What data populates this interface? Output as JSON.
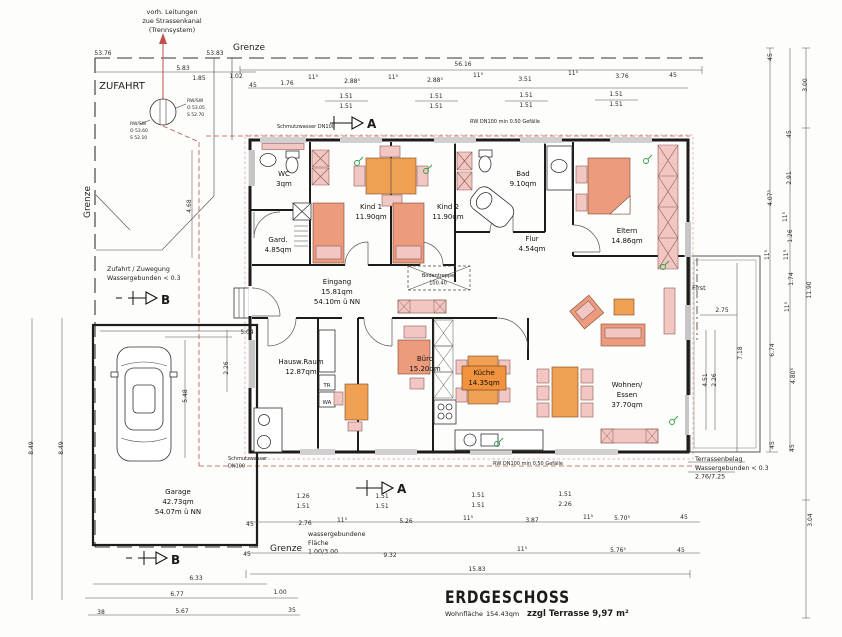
{
  "title_block": {
    "title": "ERDGESCHOSS",
    "area_label": "Wohnfläche",
    "area_value": "154.43qm",
    "terrace_note": "zzgl Terrasse 9,97 m²"
  },
  "markers": {
    "section_a": "A",
    "section_b": "B"
  },
  "colors": {
    "furniture_salmon": "#ec9b7d",
    "furniture_pink": "#f2c6c2",
    "accent_orange": "#f0a052",
    "pipe_red": "#c0504a",
    "symbol_green": "#2f9e44",
    "wall_black": "#1c1c1c"
  },
  "rooms": [
    {
      "lines": [
        "WC",
        "3qm"
      ],
      "x": 284,
      "y": 176
    },
    {
      "lines": [
        "Gard.",
        "4.85qm"
      ],
      "x": 278,
      "y": 242
    },
    {
      "lines": [
        "Kind 1",
        "11.90qm"
      ],
      "x": 371,
      "y": 209
    },
    {
      "lines": [
        "Kind 2",
        "11.90qm"
      ],
      "x": 448,
      "y": 209
    },
    {
      "lines": [
        "Bad",
        "9.10qm"
      ],
      "x": 523,
      "y": 176
    },
    {
      "lines": [
        "Eltern",
        "14.86qm"
      ],
      "x": 627,
      "y": 233
    },
    {
      "lines": [
        "Flur",
        "4.54qm"
      ],
      "x": 532,
      "y": 241
    },
    {
      "lines": [
        "Eingang",
        "15.81qm",
        "54.10m ü NN"
      ],
      "x": 337,
      "y": 284
    },
    {
      "lines": [
        "Hausw.Raum",
        "12.87qm"
      ],
      "x": 301,
      "y": 364
    },
    {
      "lines": [
        "Büro",
        "15.20qm"
      ],
      "x": 425,
      "y": 361
    },
    {
      "lines": [
        "Wohnen/",
        "Essen",
        "37.70qm"
      ],
      "x": 627,
      "y": 387
    },
    {
      "lines": [
        "Garage",
        "42.73qm",
        "54.07m ü NN"
      ],
      "x": 178,
      "y": 494
    }
  ],
  "kitchen_label": {
    "lines": [
      "Küche",
      "14.35qm"
    ],
    "x": 484,
    "y": 375
  },
  "annotations": [
    {
      "lines": [
        "vorh. Leitungen",
        "zue Strassenkanal",
        "(Trennsystem)"
      ],
      "x": 172,
      "y": 14,
      "s": 6.5,
      "a": "m"
    },
    {
      "lines": [
        "Grenze"
      ],
      "x": 249,
      "y": 50,
      "s": 9,
      "a": "m"
    },
    {
      "lines": [
        "Grenze"
      ],
      "x": 90,
      "y": 202,
      "s": 9,
      "a": "m",
      "r": -90
    },
    {
      "lines": [
        "Grenze"
      ],
      "x": 286,
      "y": 551,
      "s": 9,
      "a": "m"
    },
    {
      "lines": [
        "ZUFAHRT"
      ],
      "x": 122,
      "y": 89,
      "s": 10,
      "a": "m"
    },
    {
      "lines": [
        "Zufahrt / Zuwegung",
        "Wassergebunden < 0.3"
      ],
      "x": 107,
      "y": 271,
      "s": 6.3,
      "a": "s"
    },
    {
      "lines": [
        "wassergebundene",
        "Fläche",
        "1.00/3.00"
      ],
      "x": 308,
      "y": 536,
      "s": 6.3,
      "a": "s"
    },
    {
      "lines": [
        "Terrassenbelag",
        "Wassergebunden < 0.3",
        "2.76/7.25"
      ],
      "x": 695,
      "y": 461,
      "s": 6.3,
      "a": "s"
    },
    {
      "lines": [
        "First"
      ],
      "x": 692,
      "y": 290,
      "s": 6.5,
      "a": "s"
    },
    {
      "lines": [
        "Schmutzwasser DN100"
      ],
      "x": 277,
      "y": 128,
      "s": 5,
      "a": "s"
    },
    {
      "lines": [
        "RW DN100 min 0.50 Gefälle"
      ],
      "x": 505,
      "y": 123,
      "s": 5,
      "a": "m"
    },
    {
      "lines": [
        "RW DN100 min 0.50 Gefälle"
      ],
      "x": 528,
      "y": 465,
      "s": 5,
      "a": "m"
    },
    {
      "lines": [
        "Schmutzwasser",
        "DN100"
      ],
      "x": 228,
      "y": 460,
      "s": 5,
      "a": "s"
    },
    {
      "lines": [
        "RW/SW",
        "O 53.05",
        "S 52.70"
      ],
      "x": 187,
      "y": 102,
      "s": 4.5,
      "a": "s"
    },
    {
      "lines": [
        "RW/SW",
        "O 53.60",
        "S 52.10"
      ],
      "x": 130,
      "y": 125,
      "s": 4.5,
      "a": "s"
    },
    {
      "lines": [
        "Bodentreppe",
        "100.40"
      ],
      "x": 438,
      "y": 277,
      "s": 5,
      "a": "m"
    },
    {
      "lines": [
        "TR"
      ],
      "x": 327,
      "y": 387,
      "s": 5.5,
      "a": "m"
    },
    {
      "lines": [
        "WA"
      ],
      "x": 327,
      "y": 404,
      "s": 5.5,
      "a": "m"
    }
  ],
  "dims": [
    {
      "t": "56.16",
      "x": 463,
      "y": 66
    },
    {
      "t": "1.85",
      "x": 199,
      "y": 80
    },
    {
      "t": "1.02",
      "x": 236,
      "y": 78
    },
    {
      "t": "45",
      "x": 253,
      "y": 87
    },
    {
      "t": "1.76",
      "x": 287,
      "y": 85
    },
    {
      "t": "11⁵",
      "x": 313,
      "y": 79
    },
    {
      "t": "2.88⁵",
      "x": 352,
      "y": 83
    },
    {
      "t": "11⁵",
      "x": 393,
      "y": 79
    },
    {
      "t": "2.88⁵",
      "x": 435,
      "y": 82
    },
    {
      "t": "11⁵",
      "x": 478,
      "y": 77
    },
    {
      "t": "3.51",
      "x": 525,
      "y": 81
    },
    {
      "t": "11⁵",
      "x": 573,
      "y": 75
    },
    {
      "t": "3.76",
      "x": 622,
      "y": 78
    },
    {
      "t": "45",
      "x": 673,
      "y": 77
    },
    {
      "t": "1.51",
      "x": 346,
      "y": 98
    },
    {
      "t": "1.51",
      "x": 346,
      "y": 108
    },
    {
      "t": "1.51",
      "x": 436,
      "y": 98
    },
    {
      "t": "1.51",
      "x": 436,
      "y": 108
    },
    {
      "t": "1.51",
      "x": 526,
      "y": 97
    },
    {
      "t": "1.51",
      "x": 526,
      "y": 107
    },
    {
      "t": "1.51",
      "x": 616,
      "y": 96
    },
    {
      "t": "1.51",
      "x": 616,
      "y": 106
    },
    {
      "t": "5.83",
      "x": 183,
      "y": 70
    },
    {
      "t": "53.76",
      "x": 103,
      "y": 55
    },
    {
      "t": "53.83",
      "x": 215,
      "y": 55
    },
    {
      "t": "3.00",
      "x": 807,
      "y": 85,
      "r": 1
    },
    {
      "t": "11.90",
      "x": 811,
      "y": 290,
      "r": 1
    },
    {
      "t": "3.04",
      "x": 812,
      "y": 520,
      "r": 1
    },
    {
      "t": "45",
      "x": 772,
      "y": 57,
      "r": 1
    },
    {
      "t": "4.07⁵",
      "x": 772,
      "y": 198,
      "r": 1
    },
    {
      "t": "11⁵",
      "x": 769,
      "y": 255,
      "r": 1
    },
    {
      "t": "6.74",
      "x": 774,
      "y": 350,
      "r": 1
    },
    {
      "t": "45",
      "x": 774,
      "y": 445,
      "r": 1
    },
    {
      "t": "45",
      "x": 791,
      "y": 134,
      "r": 1
    },
    {
      "t": "2.91",
      "x": 791,
      "y": 178,
      "r": 1
    },
    {
      "t": "11⁵",
      "x": 787,
      "y": 217,
      "r": 1
    },
    {
      "t": "1.26",
      "x": 792,
      "y": 236,
      "r": 1
    },
    {
      "t": "11⁵",
      "x": 788,
      "y": 255,
      "r": 1
    },
    {
      "t": "1.74",
      "x": 793,
      "y": 279,
      "r": 1
    },
    {
      "t": "11⁵",
      "x": 789,
      "y": 307,
      "r": 1
    },
    {
      "t": "4.80⁵",
      "x": 795,
      "y": 376,
      "r": 1
    },
    {
      "t": "45",
      "x": 794,
      "y": 448,
      "r": 1
    },
    {
      "t": "2.75",
      "x": 722,
      "y": 312
    },
    {
      "t": "7.18",
      "x": 742,
      "y": 353,
      "r": 1
    },
    {
      "t": "4.51",
      "x": 707,
      "y": 380,
      "r": 1
    },
    {
      "t": "2.26",
      "x": 716,
      "y": 380,
      "r": 1
    },
    {
      "t": "8.49",
      "x": 33,
      "y": 448,
      "r": 1
    },
    {
      "t": "8.49",
      "x": 63,
      "y": 448,
      "r": 1
    },
    {
      "t": "4.68",
      "x": 191,
      "y": 206,
      "r": 1
    },
    {
      "t": "5.48",
      "x": 187,
      "y": 396,
      "r": 1
    },
    {
      "t": "2.26",
      "x": 228,
      "y": 368,
      "r": 1
    },
    {
      "t": "5.04",
      "x": 247,
      "y": 334
    },
    {
      "t": "1.26",
      "x": 303,
      "y": 498
    },
    {
      "t": "1.51",
      "x": 303,
      "y": 508
    },
    {
      "t": "1.51",
      "x": 382,
      "y": 498
    },
    {
      "t": "1.51",
      "x": 382,
      "y": 508
    },
    {
      "t": "1.51",
      "x": 478,
      "y": 497
    },
    {
      "t": "1.51",
      "x": 478,
      "y": 507
    },
    {
      "t": "1.51",
      "x": 565,
      "y": 496
    },
    {
      "t": "2.26",
      "x": 565,
      "y": 506
    },
    {
      "t": "45",
      "x": 250,
      "y": 526
    },
    {
      "t": "2.76",
      "x": 305,
      "y": 525
    },
    {
      "t": "11⁵",
      "x": 342,
      "y": 522
    },
    {
      "t": "5.26",
      "x": 406,
      "y": 523
    },
    {
      "t": "11⁵",
      "x": 468,
      "y": 520
    },
    {
      "t": "3.87",
      "x": 532,
      "y": 522
    },
    {
      "t": "11⁵",
      "x": 588,
      "y": 519
    },
    {
      "t": "5.70⁵",
      "x": 622,
      "y": 520
    },
    {
      "t": "45",
      "x": 684,
      "y": 519
    },
    {
      "t": "45",
      "x": 247,
      "y": 556
    },
    {
      "t": "9.32",
      "x": 390,
      "y": 557
    },
    {
      "t": "11⁵",
      "x": 522,
      "y": 551
    },
    {
      "t": "5.76⁵",
      "x": 618,
      "y": 552
    },
    {
      "t": "45",
      "x": 681,
      "y": 552
    },
    {
      "t": "15.83",
      "x": 477,
      "y": 571
    },
    {
      "t": "6.33",
      "x": 196,
      "y": 580
    },
    {
      "t": "6.77",
      "x": 177,
      "y": 596
    },
    {
      "t": "1.00",
      "x": 280,
      "y": 594
    },
    {
      "t": "38",
      "x": 101,
      "y": 614
    },
    {
      "t": "5.67",
      "x": 182,
      "y": 613
    },
    {
      "t": "35",
      "x": 292,
      "y": 612
    }
  ]
}
